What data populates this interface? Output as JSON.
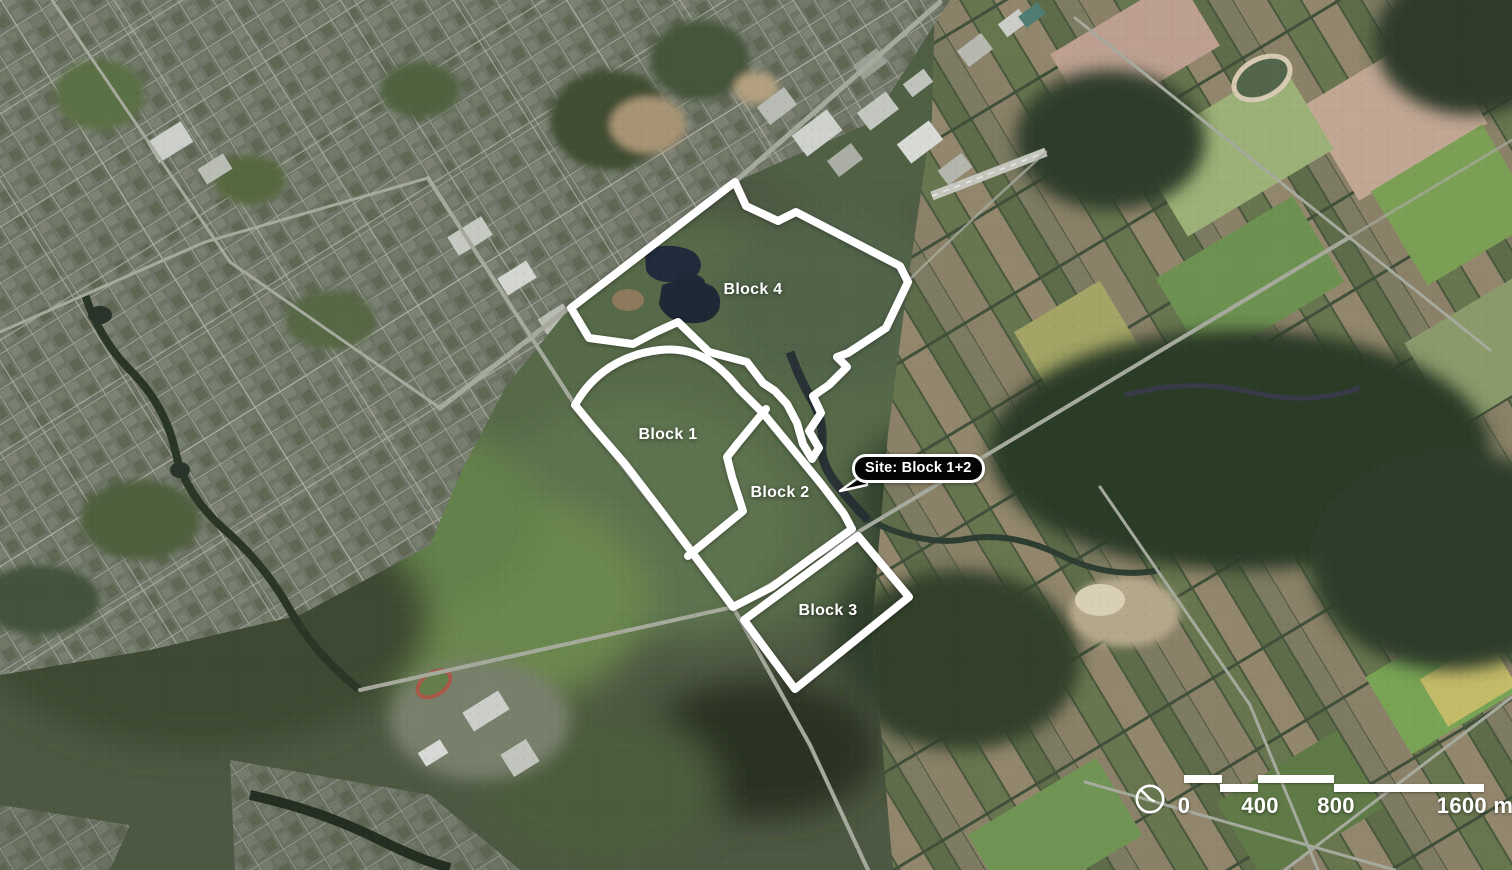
{
  "map": {
    "blocks": [
      {
        "label": "Block 1"
      },
      {
        "label": "Block 2"
      },
      {
        "label": "Block 3"
      },
      {
        "label": "Block 4"
      }
    ],
    "callout": {
      "label": "Site: Block 1+2"
    },
    "scale_bar": {
      "ticks": [
        "0",
        "400",
        "800",
        "1600 m"
      ],
      "icon": "north-arrow-clock-icon"
    },
    "colors": {
      "outline": "#ffffff",
      "label_text": "#ffffff",
      "callout_bg": "#000000",
      "callout_border": "#ffffff",
      "callout_text": "#ffffff"
    }
  }
}
